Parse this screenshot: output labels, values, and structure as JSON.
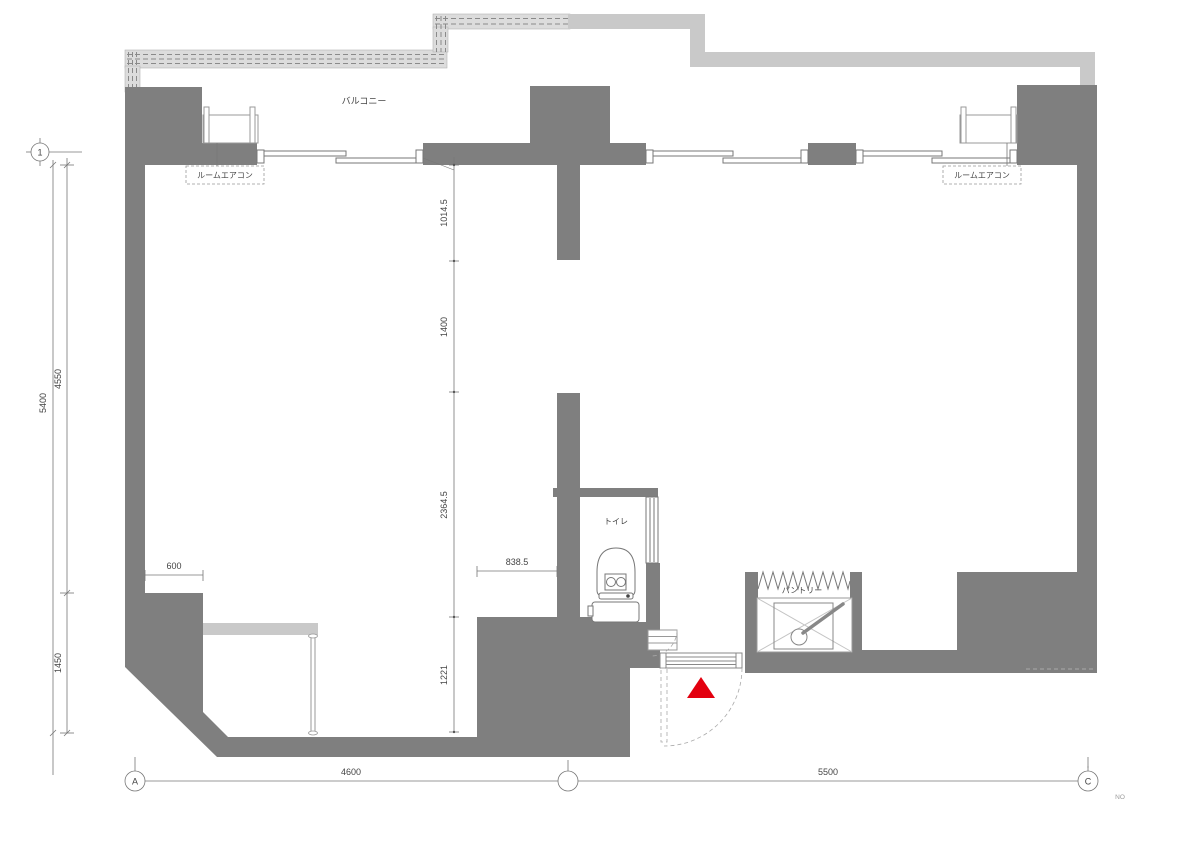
{
  "plan": {
    "labels": {
      "balcony": "バルコニー",
      "aircon_left": "ルームエアコン",
      "aircon_right": "ルームエアコン",
      "toilet": "トイレ",
      "pantry": "パントリー",
      "refrigerator": "冷蔵庫"
    },
    "grid_axes": {
      "axis_1": "1",
      "axis_a": "A",
      "axis_b": "",
      "axis_c": "C"
    },
    "dimensions_mm": {
      "left_total": "5400",
      "left_upper": "4550",
      "left_lower": "1450",
      "counter_recess": "600",
      "passage_width": "838.5",
      "center_upper": "1014.5",
      "center_opening": "1400",
      "center_mid": "2364.5",
      "center_lower": "1221",
      "span_a_b": "4600",
      "span_b_c": "5500"
    },
    "page_note": "NO",
    "colors": {
      "wall": "#7f7f7f",
      "balcony_slab": "#c9c9c9",
      "screen_band": "#dcdcdc",
      "entrance_marker": "#e3000f",
      "drawing_line": "#777777"
    }
  }
}
